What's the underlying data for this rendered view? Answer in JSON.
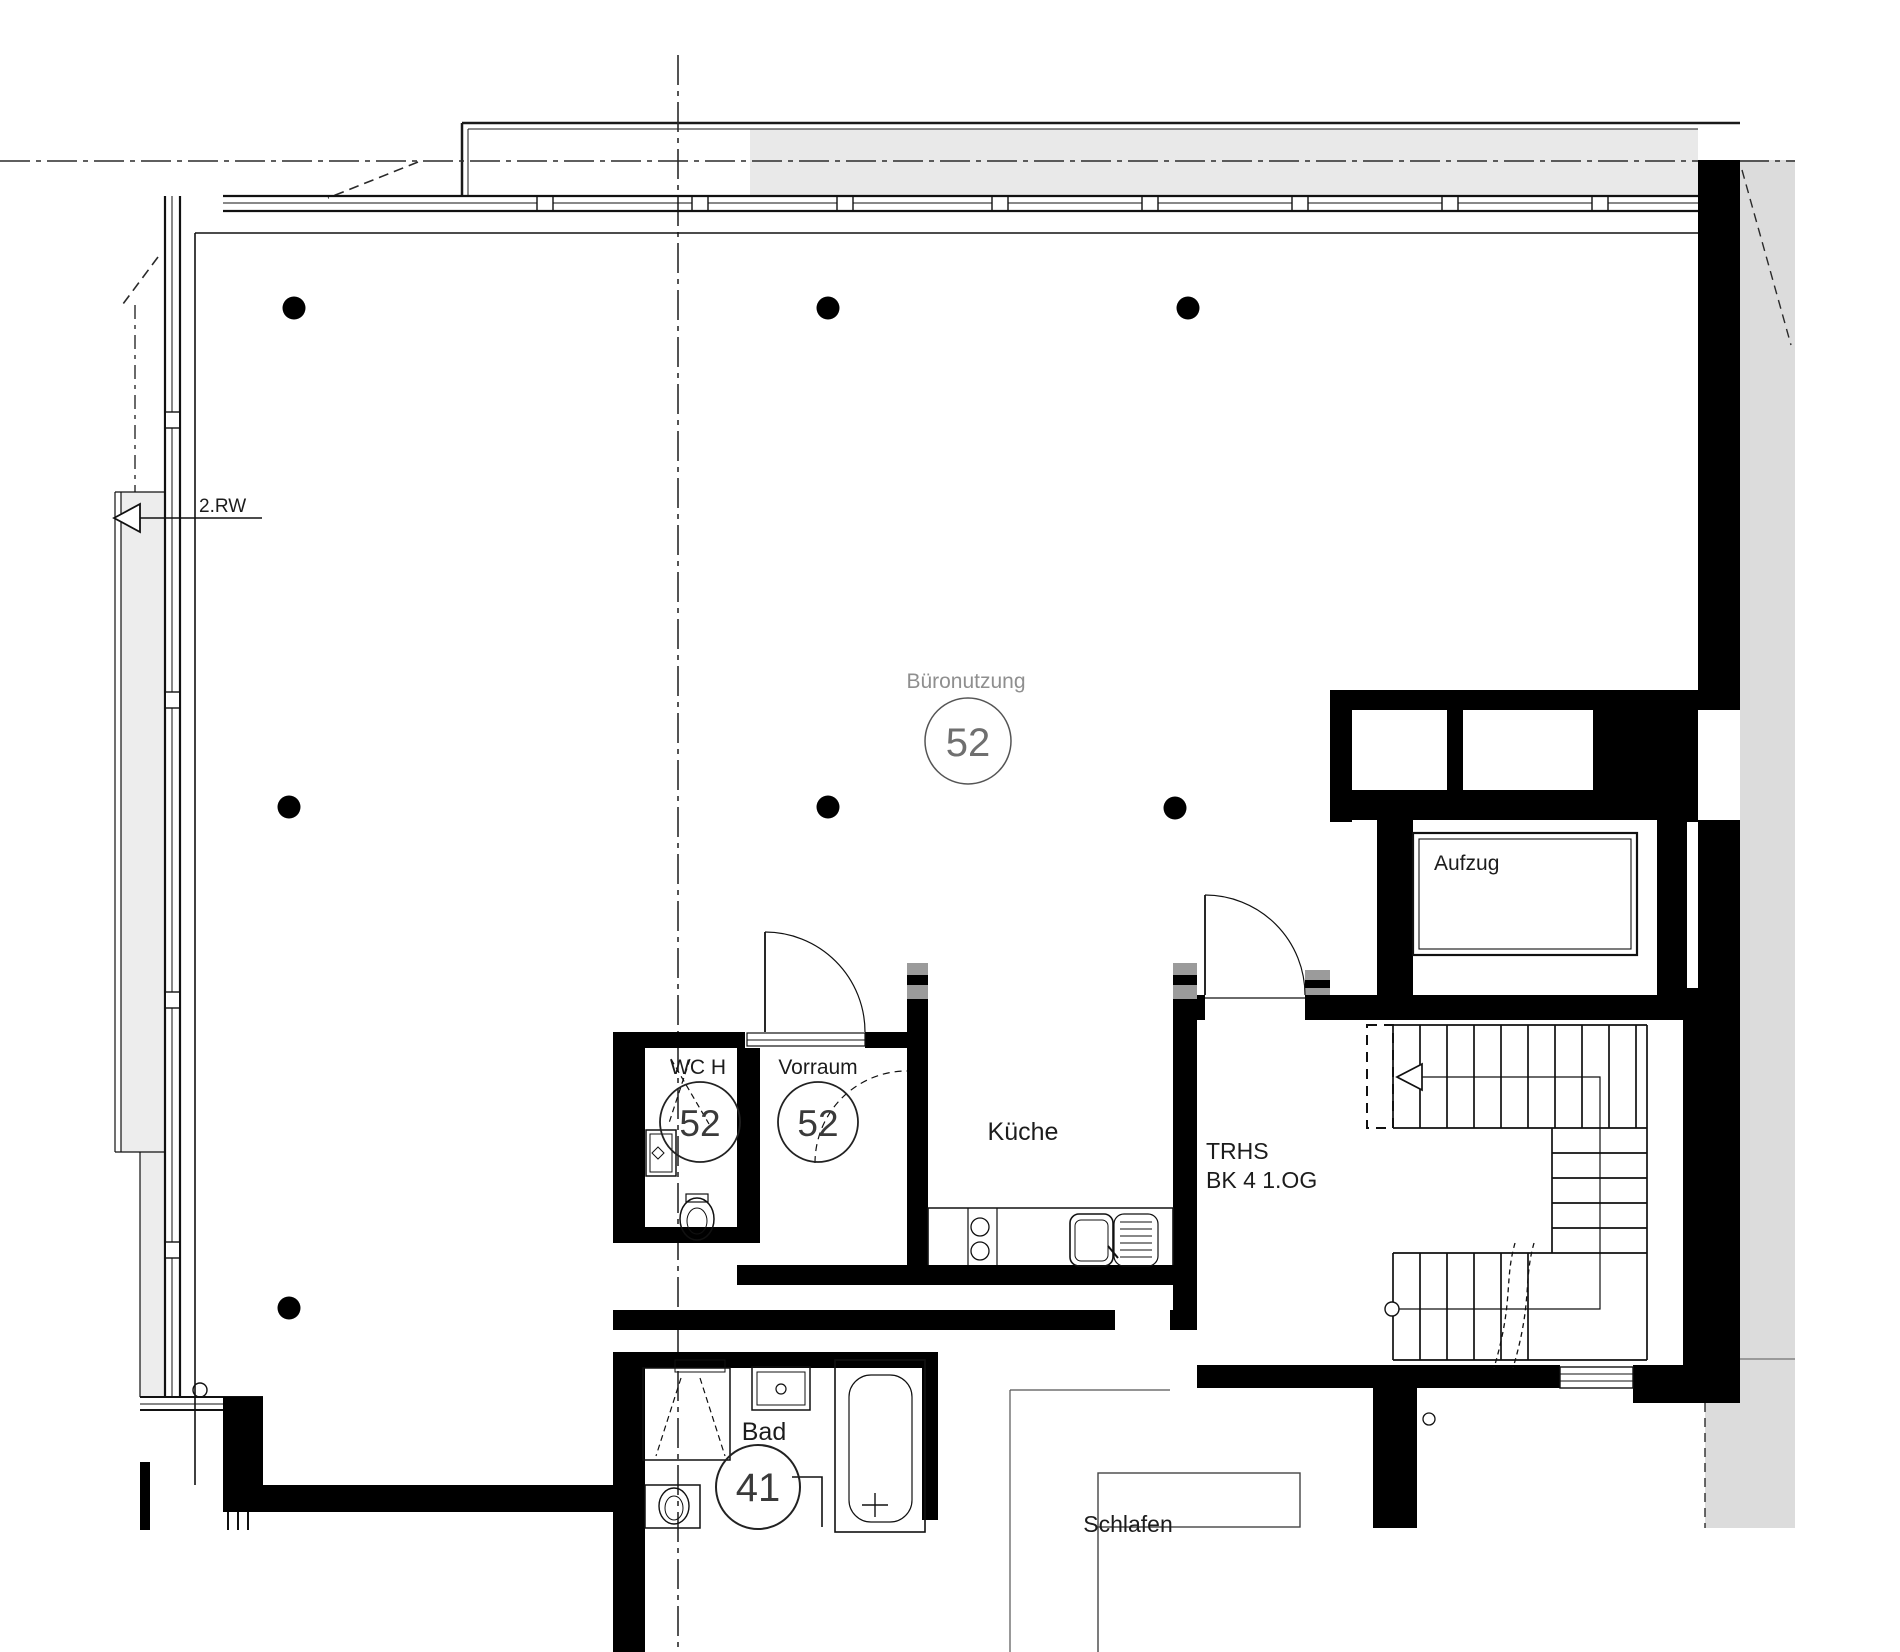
{
  "drawing_type": "architectural floor plan",
  "rooms": {
    "buero": {
      "label": "Büronutzung",
      "number": "52"
    },
    "wc": {
      "label": "WC H",
      "number": "52"
    },
    "vorraum": {
      "label": "Vorraum",
      "number": "52"
    },
    "kueche": {
      "label": "Küche"
    },
    "trhs": {
      "label": "TRHS",
      "sub": "BK 4 1.OG"
    },
    "aufzug": {
      "label": "Aufzug"
    },
    "bad": {
      "label": "Bad",
      "number": "41"
    },
    "schlafen": {
      "label": "Schlafen"
    }
  },
  "annotations": {
    "rw": "2.RW"
  },
  "colors": {
    "wall": "#000000",
    "thin_line": "#1a1a1a",
    "gray_text": "#8f8f8f",
    "balcony_fill": "#e9e9e9",
    "outside_fill": "#dcdcdc"
  }
}
